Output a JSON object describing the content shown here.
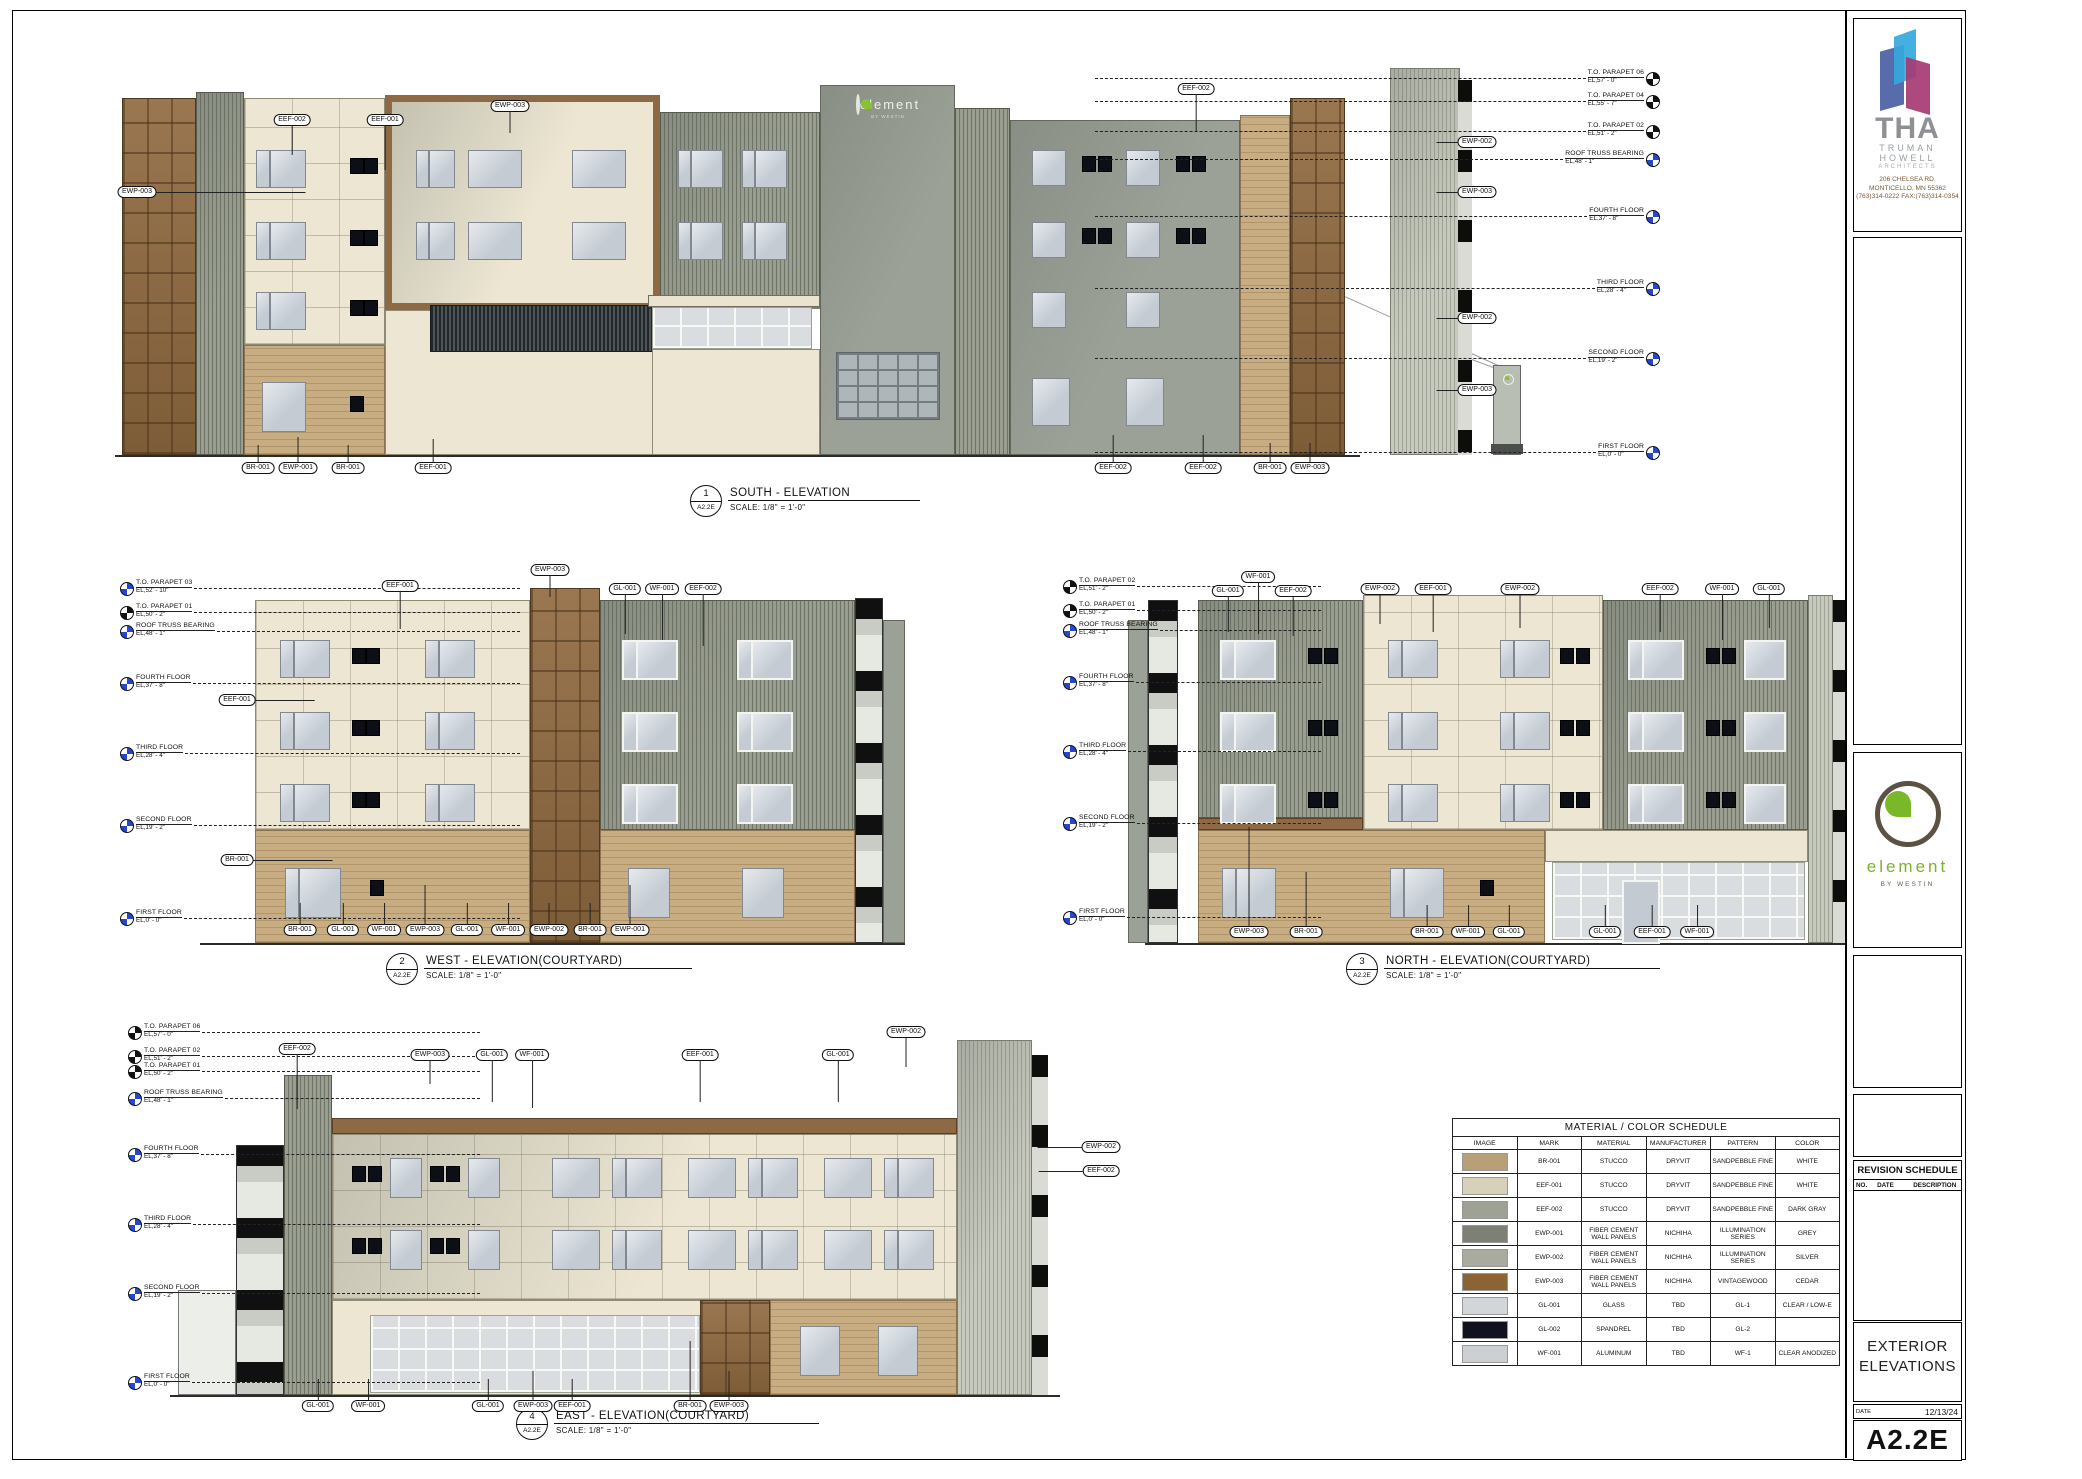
{
  "sheet": {
    "number": "A2.2E",
    "title": "EXTERIOR\nELEVATIONS",
    "date_label": "DATE",
    "date": "12/13/24"
  },
  "firm": {
    "name": "THA",
    "line1": "TRUMAN",
    "line2": "HOWELL",
    "line3": "ARCHITECTS",
    "address1": "206 CHELSEA RD.",
    "address2": "MONTICELLO, MN 55362",
    "address3": "(763)314-0222 FAX:(763)314-0354"
  },
  "brand": {
    "name": "element",
    "sub": "BY WESTIN"
  },
  "revision": {
    "title": "REVISION SCHEDULE",
    "columns": [
      "NO.",
      "DATE",
      "DESCRIPTION"
    ]
  },
  "colors": {
    "level_marker_blue": "#2547d0",
    "cream_stucco": "#ece6d2",
    "tan_brick": "#c8ad82",
    "cedar_wood": "#8d6a44",
    "panel_gray": "#9ba196",
    "brand_green": "#79b829"
  },
  "schedule": {
    "title": "MATERIAL / COLOR SCHEDULE",
    "columns": [
      "IMAGE",
      "MARK",
      "MATERIAL",
      "MANUFACTURER",
      "PATTERN",
      "COLOR"
    ],
    "rows": [
      {
        "swatch": "#b89f78",
        "mark": "BR-001",
        "material": "STUCCO",
        "manufacturer": "DRYVIT",
        "pattern": "SANDPEBBLE FINE",
        "color": "WHITE"
      },
      {
        "swatch": "#d8d1ba",
        "mark": "EEF-001",
        "material": "STUCCO",
        "manufacturer": "DRYVIT",
        "pattern": "SANDPEBBLE FINE",
        "color": "WHITE"
      },
      {
        "swatch": "#9ea295",
        "mark": "EEF-002",
        "material": "STUCCO",
        "manufacturer": "DRYVIT",
        "pattern": "SANDPEBBLE FINE",
        "color": "DARK GRAY"
      },
      {
        "swatch": "#7d8074",
        "mark": "EWP-001",
        "material": "FIBER CEMENT WALL PANELS",
        "manufacturer": "NICHIHA",
        "pattern": "ILLUMINATION SERIES",
        "color": "GREY"
      },
      {
        "swatch": "#a8ab9d",
        "mark": "EWP-002",
        "material": "FIBER CEMENT WALL PANELS",
        "manufacturer": "NICHIHA",
        "pattern": "ILLUMINATION SERIES",
        "color": "SILVER"
      },
      {
        "swatch": "#8a6434",
        "mark": "EWP-003",
        "material": "FIBER CEMENT WALL PANELS",
        "manufacturer": "NICHIHA",
        "pattern": "VINTAGEWOOD",
        "color": "CEDAR"
      },
      {
        "swatch": "#d2d6d8",
        "mark": "GL-001",
        "material": "GLASS",
        "manufacturer": "TBD",
        "pattern": "GL-1",
        "color": "CLEAR / LOW-E"
      },
      {
        "swatch": "#10131e",
        "mark": "GL-002",
        "material": "SPANDREL",
        "manufacturer": "TBD",
        "pattern": "GL-2",
        "color": ""
      },
      {
        "swatch": "#ccd0d2",
        "mark": "WF-001",
        "material": "ALUMINUM",
        "manufacturer": "TBD",
        "pattern": "WF-1",
        "color": "CLEAR ANODIZED"
      }
    ]
  },
  "views": [
    {
      "num": "1",
      "ref": "A2.2E",
      "name": "SOUTH - ELEVATION",
      "scale_label": "SCALE:",
      "scale": "1/8\" = 1'-0\"",
      "x": 690,
      "y": 485
    },
    {
      "num": "2",
      "ref": "A2.2E",
      "name": "WEST - ELEVATION(COURTYARD)",
      "scale_label": "SCALE:",
      "scale": "1/8\" = 1'-0\"",
      "x": 386,
      "y": 953
    },
    {
      "num": "3",
      "ref": "A2.2E",
      "name": "NORTH - ELEVATION(COURTYARD)",
      "scale_label": "SCALE:",
      "scale": "1/8\" = 1'-0\"",
      "x": 1346,
      "y": 953
    },
    {
      "num": "4",
      "ref": "A2.2E",
      "name": "EAST - ELEVATION(COURTYARD)",
      "scale_label": "SCALE:",
      "scale": "1/8\" = 1'-0\"",
      "x": 516,
      "y": 1408
    }
  ],
  "levels": [
    {
      "side": "r",
      "x": 1095,
      "w": 565,
      "y": 78,
      "n": "T.O. PARAPET 06",
      "e": "EL,57' - 0\"",
      "c": "black"
    },
    {
      "side": "r",
      "x": 1095,
      "w": 565,
      "y": 101,
      "n": "T.O. PARAPET 04",
      "e": "EL,55' - 7\"",
      "c": "black"
    },
    {
      "side": "r",
      "x": 1095,
      "w": 565,
      "y": 131,
      "n": "T.O. PARAPET 02",
      "e": "EL,51' - 2\"",
      "c": "black"
    },
    {
      "side": "r",
      "x": 1095,
      "w": 565,
      "y": 159,
      "n": "ROOF TRUSS BEARING",
      "e": "EL,48' - 1\"",
      "c": "blue"
    },
    {
      "side": "r",
      "x": 1095,
      "w": 565,
      "y": 216,
      "n": "FOURTH FLOOR",
      "e": "EL,37' - 8\"",
      "c": "blue"
    },
    {
      "side": "r",
      "x": 1095,
      "w": 565,
      "y": 288,
      "n": "THIRD FLOOR",
      "e": "EL,28' - 4\"",
      "c": "blue"
    },
    {
      "side": "r",
      "x": 1095,
      "w": 565,
      "y": 358,
      "n": "SECOND FLOOR",
      "e": "EL,19' - 2\"",
      "c": "blue"
    },
    {
      "side": "r",
      "x": 1095,
      "w": 565,
      "y": 452,
      "n": "FIRST FLOOR",
      "e": "EL,0' - 0\"",
      "c": "blue"
    },
    {
      "side": "l",
      "x": 120,
      "w": 400,
      "y": 588,
      "n": "T.O. PARAPET 03",
      "e": "EL,52' - 10\"",
      "c": "blue"
    },
    {
      "side": "l",
      "x": 120,
      "w": 400,
      "y": 612,
      "n": "T.O. PARAPET 01",
      "e": "EL,50' - 2\"",
      "c": "black"
    },
    {
      "side": "l",
      "x": 120,
      "w": 400,
      "y": 631,
      "n": "ROOF TRUSS BEARING",
      "e": "EL,48' - 1\"",
      "c": "blue"
    },
    {
      "side": "l",
      "x": 120,
      "w": 400,
      "y": 683,
      "n": "FOURTH FLOOR",
      "e": "EL,37' - 8\"",
      "c": "blue"
    },
    {
      "side": "l",
      "x": 120,
      "w": 400,
      "y": 753,
      "n": "THIRD FLOOR",
      "e": "EL,28' - 4\"",
      "c": "blue"
    },
    {
      "side": "l",
      "x": 120,
      "w": 400,
      "y": 825,
      "n": "SECOND FLOOR",
      "e": "EL,19' - 2\"",
      "c": "blue"
    },
    {
      "side": "l",
      "x": 120,
      "w": 400,
      "y": 918,
      "n": "FIRST FLOOR",
      "e": "EL,0' - 0\"",
      "c": "blue"
    },
    {
      "side": "l",
      "x": 1063,
      "w": 258,
      "y": 586,
      "n": "T.O. PARAPET 02",
      "e": "EL,51' - 2\"",
      "c": "black"
    },
    {
      "side": "l",
      "x": 1063,
      "w": 258,
      "y": 610,
      "n": "T.O. PARAPET 01",
      "e": "EL,50' - 2\"",
      "c": "black"
    },
    {
      "side": "l",
      "x": 1063,
      "w": 258,
      "y": 630,
      "n": "ROOF TRUSS BEARING",
      "e": "EL,48' - 1\"",
      "c": "blue"
    },
    {
      "side": "l",
      "x": 1063,
      "w": 258,
      "y": 682,
      "n": "FOURTH FLOOR",
      "e": "EL,37' - 8\"",
      "c": "blue"
    },
    {
      "side": "l",
      "x": 1063,
      "w": 258,
      "y": 751,
      "n": "THIRD FLOOR",
      "e": "EL,28' - 4\"",
      "c": "blue"
    },
    {
      "side": "l",
      "x": 1063,
      "w": 258,
      "y": 823,
      "n": "SECOND FLOOR",
      "e": "EL,19' - 2\"",
      "c": "blue"
    },
    {
      "side": "l",
      "x": 1063,
      "w": 258,
      "y": 917,
      "n": "FIRST FLOOR",
      "e": "EL,0' - 0\"",
      "c": "blue"
    },
    {
      "side": "l",
      "x": 128,
      "w": 352,
      "y": 1032,
      "n": "T.O. PARAPET 06",
      "e": "EL,57' - 0\"",
      "c": "black"
    },
    {
      "side": "l",
      "x": 128,
      "w": 352,
      "y": 1056,
      "n": "T.O. PARAPET 02",
      "e": "EL,51' - 2\"",
      "c": "black"
    },
    {
      "side": "l",
      "x": 128,
      "w": 352,
      "y": 1071,
      "n": "T.O. PARAPET 01",
      "e": "EL,50' - 2\"",
      "c": "black"
    },
    {
      "side": "l",
      "x": 128,
      "w": 352,
      "y": 1098,
      "n": "ROOF TRUSS BEARING",
      "e": "EL,48' - 1\"",
      "c": "blue"
    },
    {
      "side": "l",
      "x": 128,
      "w": 352,
      "y": 1154,
      "n": "FOURTH FLOOR",
      "e": "EL,37' - 8\"",
      "c": "blue"
    },
    {
      "side": "l",
      "x": 128,
      "w": 352,
      "y": 1224,
      "n": "THIRD FLOOR",
      "e": "EL,28' - 4\"",
      "c": "blue"
    },
    {
      "side": "l",
      "x": 128,
      "w": 352,
      "y": 1293,
      "n": "SECOND FLOOR",
      "e": "EL,19' - 2\"",
      "c": "blue"
    },
    {
      "side": "l",
      "x": 128,
      "w": 352,
      "y": 1382,
      "n": "FIRST FLOOR",
      "e": "EL,0' - 0\"",
      "c": "blue"
    }
  ],
  "tags": [
    {
      "t": "EEF-002",
      "x": 292,
      "y": 120,
      "ld": 30
    },
    {
      "t": "EEF-001",
      "x": 385,
      "y": 120,
      "ld": 45
    },
    {
      "t": "EWP-003",
      "x": 510,
      "y": 106,
      "ld": 22
    },
    {
      "t": "EEF-002",
      "x": 1196,
      "y": 89,
      "ld": 38
    },
    {
      "t": "EWP-003",
      "x": 137,
      "y": 192,
      "lh": 150
    },
    {
      "t": "EWP-002",
      "x": 1477,
      "y": 142,
      "lh": -22
    },
    {
      "t": "EWP-003",
      "x": 1477,
      "y": 192,
      "lh": -22
    },
    {
      "t": "EWP-002",
      "x": 1477,
      "y": 318,
      "lh": -22
    },
    {
      "t": "EWP-003",
      "x": 1477,
      "y": 390,
      "lh": -22
    },
    {
      "t": "BR-001",
      "x": 258,
      "y": 468,
      "ld": -18
    },
    {
      "t": "EWP-001",
      "x": 298,
      "y": 468,
      "ld": -26
    },
    {
      "t": "BR-001",
      "x": 348,
      "y": 468,
      "ld": -18
    },
    {
      "t": "EEF-001",
      "x": 433,
      "y": 468,
      "ld": -24
    },
    {
      "t": "EEF-002",
      "x": 1113,
      "y": 468,
      "ld": -28
    },
    {
      "t": "EEF-002",
      "x": 1203,
      "y": 468,
      "ld": -28
    },
    {
      "t": "BR-001",
      "x": 1270,
      "y": 468,
      "ld": -20
    },
    {
      "t": "EWP-003",
      "x": 1310,
      "y": 468,
      "ld": -20
    },
    {
      "t": "EEF-001",
      "x": 400,
      "y": 586,
      "ld": 38
    },
    {
      "t": "EWP-003",
      "x": 550,
      "y": 570,
      "ld": 22
    },
    {
      "t": "GL-001",
      "x": 625,
      "y": 589,
      "ld": 40
    },
    {
      "t": "WF-001",
      "x": 662,
      "y": 589,
      "ld": 46
    },
    {
      "t": "EEF-002",
      "x": 703,
      "y": 589,
      "ld": 52
    },
    {
      "t": "EEF-001",
      "x": 237,
      "y": 700,
      "lh": 60
    },
    {
      "t": "BR-001",
      "x": 237,
      "y": 860,
      "lh": 80
    },
    {
      "t": "BR-001",
      "x": 300,
      "y": 930,
      "ld": -22
    },
    {
      "t": "GL-001",
      "x": 343,
      "y": 930,
      "ld": -22
    },
    {
      "t": "WF-001",
      "x": 384,
      "y": 930,
      "ld": -22
    },
    {
      "t": "EWP-003",
      "x": 425,
      "y": 930,
      "ld": -40
    },
    {
      "t": "GL-001",
      "x": 467,
      "y": 930,
      "ld": -22
    },
    {
      "t": "WF-001",
      "x": 508,
      "y": 930,
      "ld": -22
    },
    {
      "t": "EWP-002",
      "x": 549,
      "y": 930,
      "ld": -22
    },
    {
      "t": "BR-001",
      "x": 590,
      "y": 930,
      "ld": -22
    },
    {
      "t": "EWP-001",
      "x": 630,
      "y": 930,
      "ld": -40
    },
    {
      "t": "GL-001",
      "x": 1228,
      "y": 591,
      "ld": 36
    },
    {
      "t": "WF-001",
      "x": 1258,
      "y": 577,
      "ld": 52
    },
    {
      "t": "EEF-002",
      "x": 1293,
      "y": 591,
      "ld": 40
    },
    {
      "t": "EWP-002",
      "x": 1380,
      "y": 589,
      "ld": 30
    },
    {
      "t": "EEF-001",
      "x": 1433,
      "y": 589,
      "ld": 38
    },
    {
      "t": "EWP-002",
      "x": 1520,
      "y": 589,
      "ld": 34
    },
    {
      "t": "EEF-002",
      "x": 1660,
      "y": 589,
      "ld": 38
    },
    {
      "t": "WF-001",
      "x": 1722,
      "y": 589,
      "ld": 46
    },
    {
      "t": "GL-001",
      "x": 1769,
      "y": 589,
      "ld": 34
    },
    {
      "t": "EWP-003",
      "x": 1249,
      "y": 932,
      "ld": -100
    },
    {
      "t": "BR-001",
      "x": 1306,
      "y": 932,
      "ld": -55
    },
    {
      "t": "BR-001",
      "x": 1427,
      "y": 932,
      "ld": -22
    },
    {
      "t": "WF-001",
      "x": 1468,
      "y": 932,
      "ld": -22
    },
    {
      "t": "GL-001",
      "x": 1509,
      "y": 932,
      "ld": -22
    },
    {
      "t": "GL-001",
      "x": 1605,
      "y": 932,
      "ld": -22
    },
    {
      "t": "EEF-001",
      "x": 1652,
      "y": 932,
      "ld": -22
    },
    {
      "t": "WF-001",
      "x": 1697,
      "y": 932,
      "ld": -22
    },
    {
      "t": "EEF-002",
      "x": 297,
      "y": 1049,
      "ld": 55
    },
    {
      "t": "EWP-003",
      "x": 430,
      "y": 1055,
      "ld": 24
    },
    {
      "t": "GL-001",
      "x": 492,
      "y": 1055,
      "ld": 42
    },
    {
      "t": "WF-001",
      "x": 532,
      "y": 1055,
      "ld": 48
    },
    {
      "t": "EEF-001",
      "x": 700,
      "y": 1055,
      "ld": 42
    },
    {
      "t": "GL-001",
      "x": 838,
      "y": 1055,
      "ld": 42
    },
    {
      "t": "EWP-002",
      "x": 906,
      "y": 1032,
      "ld": 30
    },
    {
      "t": "EWP-002",
      "x": 1101,
      "y": 1147,
      "lh": -45
    },
    {
      "t": "EEF-002",
      "x": 1101,
      "y": 1171,
      "lh": -45
    },
    {
      "t": "GL-001",
      "x": 318,
      "y": 1406,
      "ld": -22
    },
    {
      "t": "WF-001",
      "x": 368,
      "y": 1406,
      "ld": -22
    },
    {
      "t": "GL-001",
      "x": 488,
      "y": 1406,
      "ld": -22
    },
    {
      "t": "EWP-003",
      "x": 533,
      "y": 1406,
      "ld": -30
    },
    {
      "t": "EEF-001",
      "x": 572,
      "y": 1406,
      "ld": -22
    },
    {
      "t": "BR-001",
      "x": 690,
      "y": 1406,
      "ld": -60
    },
    {
      "t": "EWP-003",
      "x": 729,
      "y": 1406,
      "ld": -30
    }
  ]
}
